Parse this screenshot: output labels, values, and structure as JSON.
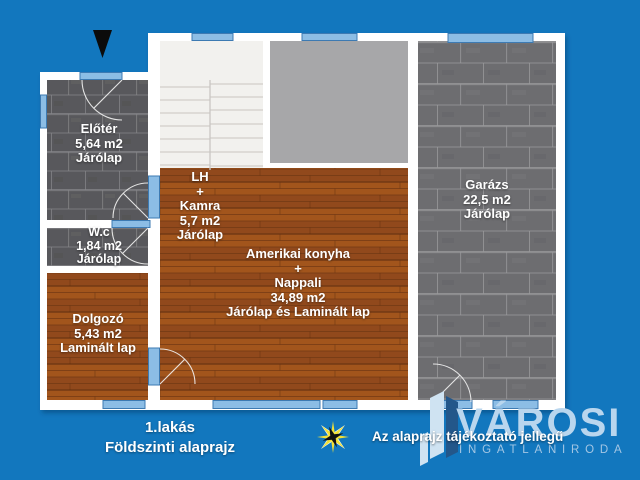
{
  "rooms": {
    "eloter": {
      "name": "Előtér",
      "area": "5,64 m2",
      "floor": "Járólap"
    },
    "wc": {
      "name": "W.c",
      "area": "1,84 m2",
      "floor": "Járólap"
    },
    "dolgozo": {
      "name": "Dolgozó",
      "area": "5,43 m2",
      "floor": "Laminált lap"
    },
    "lh_kamra": {
      "name": "LH",
      "plus": "+",
      "name2": "Kamra",
      "area": "5,7 m2",
      "floor": "Járólap"
    },
    "nappali": {
      "name": "Amerikai konyha",
      "plus": "+",
      "name2": "Nappali",
      "area": "34,89 m2",
      "floor": "Járólap és Laminált lap"
    },
    "garazs": {
      "name": "Garázs",
      "area": "22,5 m2",
      "floor": "Járólap"
    }
  },
  "footer": {
    "unit_label": "1.lakás",
    "plan_label": "Földszinti alaprajz",
    "disclaimer": "Az alaprajz tájékoztató jellegű"
  },
  "brand": {
    "name": "VÁROSI",
    "subtitle": "INGATLANIRODA"
  },
  "icons": {
    "north_arrow": "▼",
    "compass_star": "✸",
    "brand_building": "▮"
  },
  "colors": {
    "background": "#1277be",
    "wall": "#ffffff",
    "opening_blue": "#8cbde5",
    "tile_dark": "#59595b",
    "tile_garage": "#6d6d70",
    "wood_brown": "#9a4e1c",
    "stairs": "#f2f1ee",
    "landing_gray": "#a7a7a9",
    "brand_blue": "#b9d6ee",
    "star_yellow": "#f2e136"
  }
}
